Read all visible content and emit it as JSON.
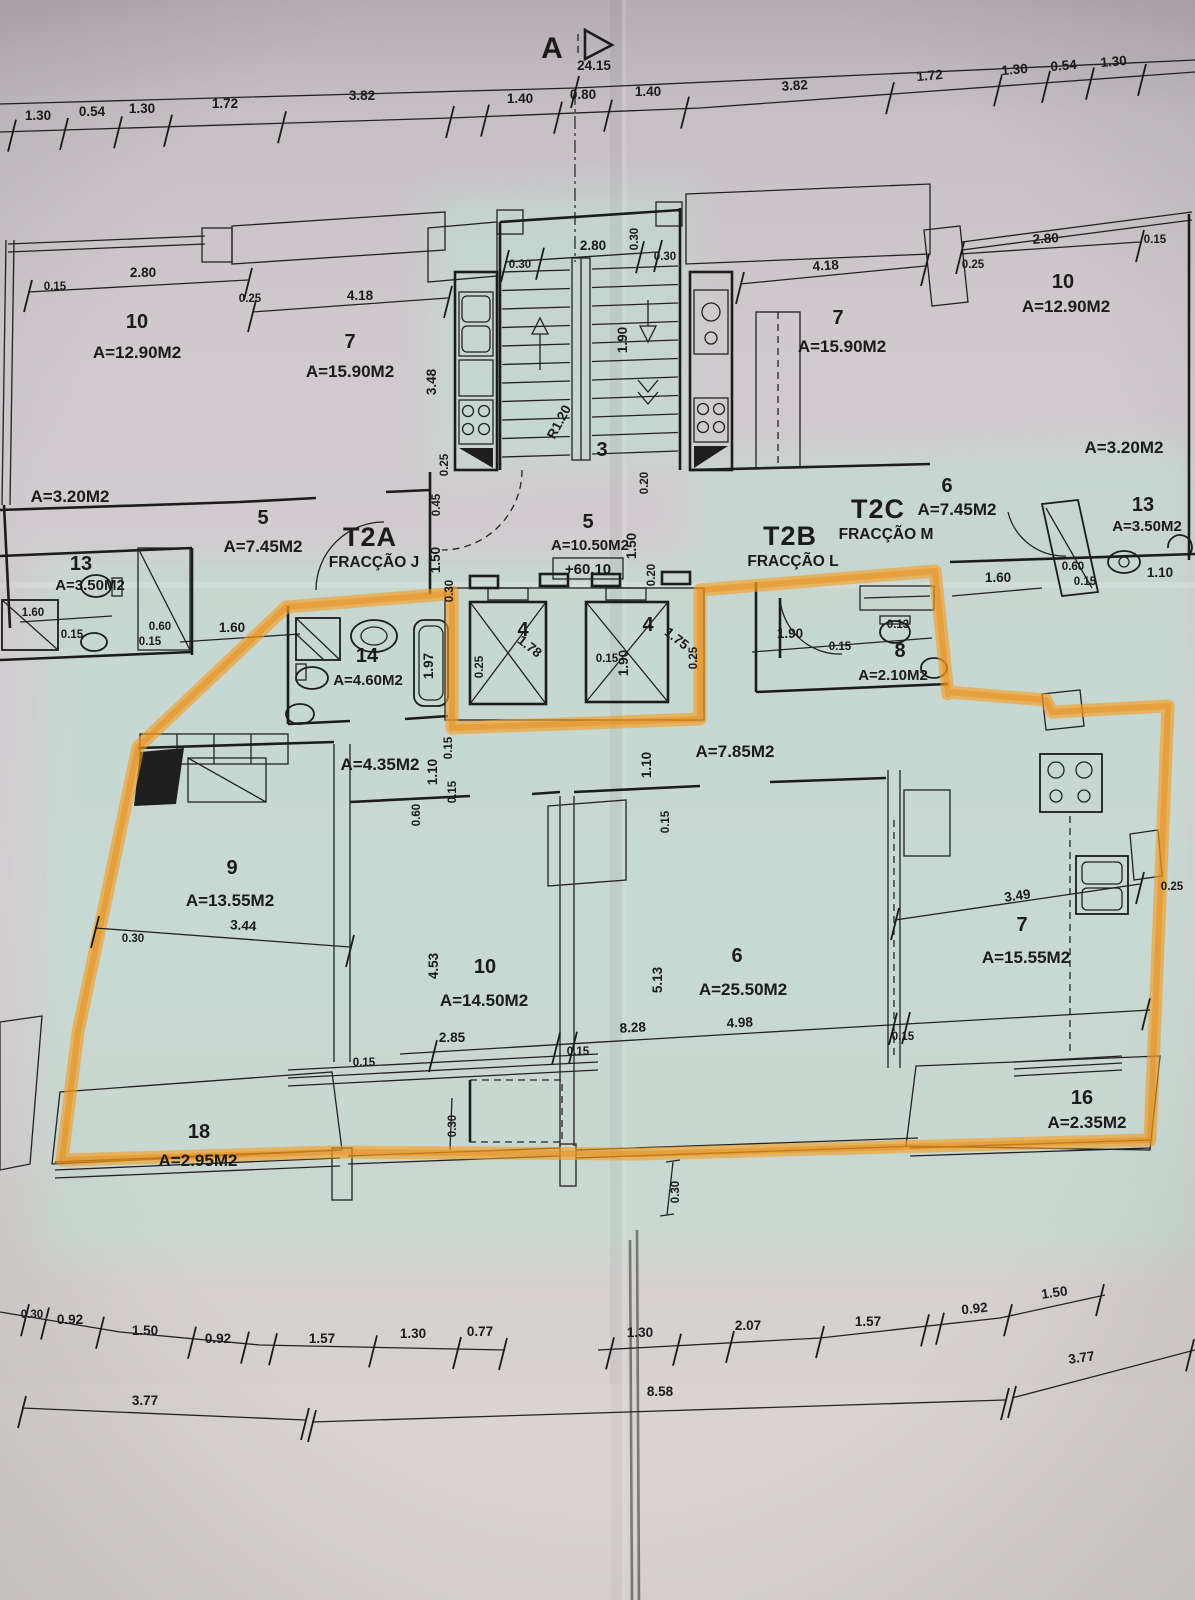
{
  "section_marker": "A",
  "fractions": {
    "t2a": {
      "code": "T2A",
      "name": "FRACÇÃO J"
    },
    "t2b": {
      "code": "T2B",
      "name": "FRACÇÃO L"
    },
    "t2c": {
      "code": "T2C",
      "name": "FRACÇÃO M"
    }
  },
  "rooms": {
    "left_10": {
      "num": "10",
      "area": "A=12.90M2"
    },
    "left_7": {
      "num": "7",
      "area": "A=15.90M2"
    },
    "left_balcony": {
      "area": "A=3.20M2"
    },
    "left_5": {
      "num": "5",
      "area": "A=7.45M2"
    },
    "left_13": {
      "num": "13",
      "area": "A=3.50M2"
    },
    "stair_hall": {
      "num": "3"
    },
    "landing": {
      "num": "5",
      "area": "A=10.50M2",
      "level": "+60.10"
    },
    "elevator_left": {
      "num": "4"
    },
    "elevator_right": {
      "num": "4"
    },
    "right_10": {
      "num": "10",
      "area": "A=12.90M2"
    },
    "right_7": {
      "num": "7",
      "area": "A=15.90M2"
    },
    "right_balcony": {
      "area": "A=3.20M2"
    },
    "right_6": {
      "num": "6",
      "area": "A=7.45M2"
    },
    "right_13": {
      "num": "13",
      "area": "A=3.50M2"
    },
    "apt_bath14": {
      "num": "14",
      "area": "A=4.60M2"
    },
    "apt_hall": {
      "area": "A=4.35M2"
    },
    "apt_hall2": {
      "area": "A=7.85M2"
    },
    "apt_wc8": {
      "num": "8",
      "area": "A=2.10M2"
    },
    "apt_9": {
      "num": "9",
      "area": "A=13.55M2"
    },
    "apt_10": {
      "num": "10",
      "area": "A=14.50M2"
    },
    "apt_6": {
      "num": "6",
      "area": "A=25.50M2"
    },
    "apt_7": {
      "num": "7",
      "area": "A=15.55M2"
    },
    "balcony_18": {
      "num": "18",
      "area": "A=2.95M2"
    },
    "balcony_16": {
      "num": "16",
      "area": "A=2.35M2"
    }
  },
  "dims": {
    "total_top": "24.15",
    "top_left": [
      "1.30",
      "0.54",
      "1.30",
      "1.72",
      "3.82"
    ],
    "top_center": [
      "1.40",
      "0.80",
      "1.40"
    ],
    "top_right": [
      "3.82",
      "1.72",
      "1.30",
      "0.54",
      "1.30"
    ],
    "left_unit": [
      "0.15",
      "2.80",
      "0.25",
      "4.18",
      "3.48",
      "0.25"
    ],
    "stair_top": [
      "0.30",
      "2.80",
      "0.30",
      "0.30"
    ],
    "stair": [
      "1.90",
      "R1.20"
    ],
    "core_vertical": [
      "0.45",
      "1.50",
      "0.30",
      "0.20",
      "1.50",
      "0.20"
    ],
    "elevator": [
      "1.78",
      "0.25",
      "1.75",
      "0.25",
      "0.15",
      "1.90"
    ],
    "left_bath": [
      "1.60",
      "0.15",
      "0.60",
      "0.15",
      "1.60"
    ],
    "right_unit": [
      "2.80",
      "0.15",
      "0.25",
      "4.18"
    ],
    "right_bath": [
      "1.60",
      "0.60",
      "0.15",
      "1.10"
    ],
    "t2b_entry": [
      "1.90",
      "0.15",
      "0.13"
    ],
    "apartment": {
      "bath_tub": "1.97",
      "hall_left": [
        "1.10",
        "0.15",
        "0.15",
        "0.60"
      ],
      "hall_right": [
        "1.10",
        "0.15"
      ],
      "room9": [
        "3.44",
        "0.30"
      ],
      "room10": [
        "4.53",
        "2.85",
        "0.15"
      ],
      "room6": [
        "5.13",
        "8.28",
        "4.98"
      ],
      "kitchen": [
        "3.49",
        "0.15",
        "0.25"
      ],
      "balcony": [
        "0.15",
        "0.30",
        "0.30"
      ]
    },
    "bottom_row1": [
      "0.30",
      "0.92",
      "1.50",
      "0.92",
      "1.57",
      "1.30",
      "0.77",
      "1.30",
      "2.07",
      "1.57",
      "0.92",
      "1.50"
    ],
    "bottom_row2": [
      "3.77",
      "8.58",
      "3.77"
    ]
  },
  "colors": {
    "highlighter": "#f39c1f",
    "paper": "#cdc7cb",
    "tint": "#c2ded2",
    "ink": "#1b1b1b"
  }
}
